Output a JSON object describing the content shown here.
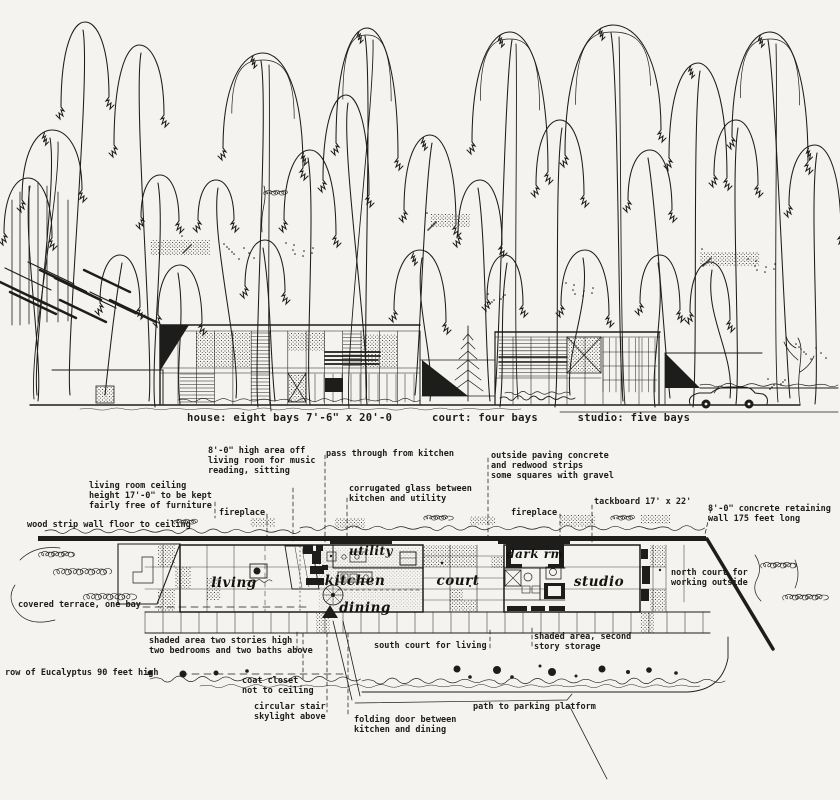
{
  "colors": {
    "paper": "#f4f3ef",
    "ink": "#1d1d1b"
  },
  "elevation_caption": "house: eight bays 7'-6\" x 20'-0      court: four bays      studio: five bays",
  "plan": {
    "rooms": {
      "living": "living",
      "utility": "utility",
      "kitchen": "kitchen",
      "dining": "dining",
      "court": "court",
      "dark_rm": "dark rm",
      "studio": "studio"
    },
    "annotations": {
      "high_area": "8'-0\" high area off\nliving room for music\nreading, sitting",
      "pass_through": "pass through from kitchen",
      "outside_paving": "outside paving concrete\nand redwood strips\nsome squares with gravel",
      "ceiling_height": "living room ceiling\nheight 17'-0\" to be kept\nfairly free of furniture",
      "corrugated_glass": "corrugated glass between\nkitchen and utility",
      "fireplace_left": "fireplace",
      "fireplace_right": "fireplace",
      "tackboard": "tackboard 17' x 22'",
      "retaining_wall": "8'-0\" concrete retaining\nwall 175 feet long",
      "wood_strip": "wood strip wall floor to ceiling",
      "covered_terrace": "covered terrace, one bay",
      "north_court": "north court for\nworking outside",
      "shaded_two_story": "shaded area two stories high\ntwo bedrooms and two baths above",
      "south_court": "south court for living",
      "shaded_storage": "shaded area, second\nstory storage",
      "eucalyptus_row": "row of Eucalyptus 90 feet high",
      "coat_closet": "coat closet\nnot to ceiling",
      "circular_stair": "circular stair\nskylight above",
      "folding_door": "folding door between\nkitchen and dining",
      "path_parking": "path to parking platform"
    }
  }
}
